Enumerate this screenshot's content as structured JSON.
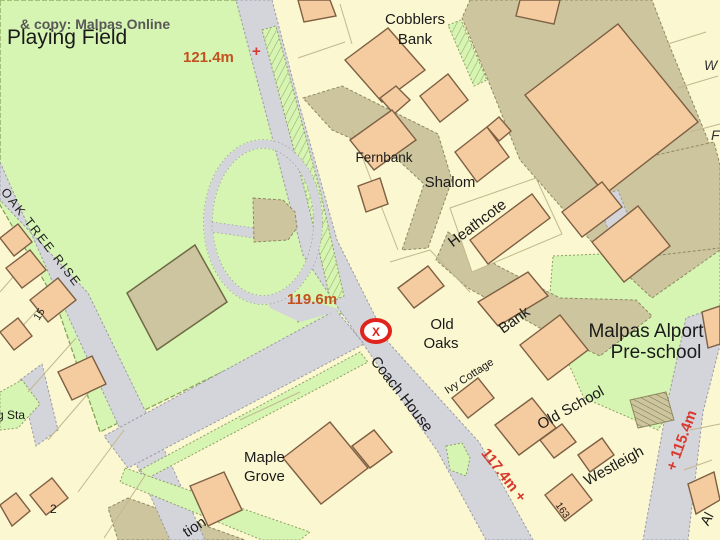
{
  "labels": {
    "watermark": "& copy: Malpas Online",
    "playing_field": "Playing Field",
    "cobblers_1": "Cobblers",
    "cobblers_2": "Bank",
    "fernbank": "Fernbank",
    "shalom": "Shalom",
    "heathcote": "Heathcote",
    "old_oaks_1": "Old",
    "old_oaks_2": "Oaks",
    "bank": "Bank",
    "ivy_cottage": "Ivy Cottage",
    "preschool_1": "Malpas Alport",
    "preschool_2": "Pre-school",
    "coach_house": "Coach House",
    "maple_1": "Maple",
    "maple_2": "Grove",
    "old_school": "Old School",
    "westleigh": "Westleigh",
    "oak_tree_rise": "OAK TREE RISE",
    "pumping_sta_partial": "g Sta",
    "station_partial": "tion",
    "w_partial": "W",
    "f_partial": "F",
    "al_partial": "Al",
    "no_2": "2",
    "no_15": "15",
    "no_163": "163"
  },
  "spot_heights": {
    "h1": "121.4m",
    "h1_cross": "+",
    "h2": "119.6m",
    "h3": "117.4m +",
    "h4": "+ 115.4m"
  },
  "marker": {
    "label": "X"
  },
  "colors": {
    "background_cream": "#fbf7d0",
    "road_gray": "#d4d4db",
    "field_green": "#d6f4b2",
    "preschool_green": "#cdeeb4",
    "tarmac_olive": "#ccc59e",
    "building_peach": "#f4cca0",
    "building_outline": "#7d5f43",
    "spot_height_orange": "#c2511f",
    "spot_height_red": "#d8392e",
    "marker_red": "#e0231c",
    "label_ink": "#1a1a1a"
  }
}
